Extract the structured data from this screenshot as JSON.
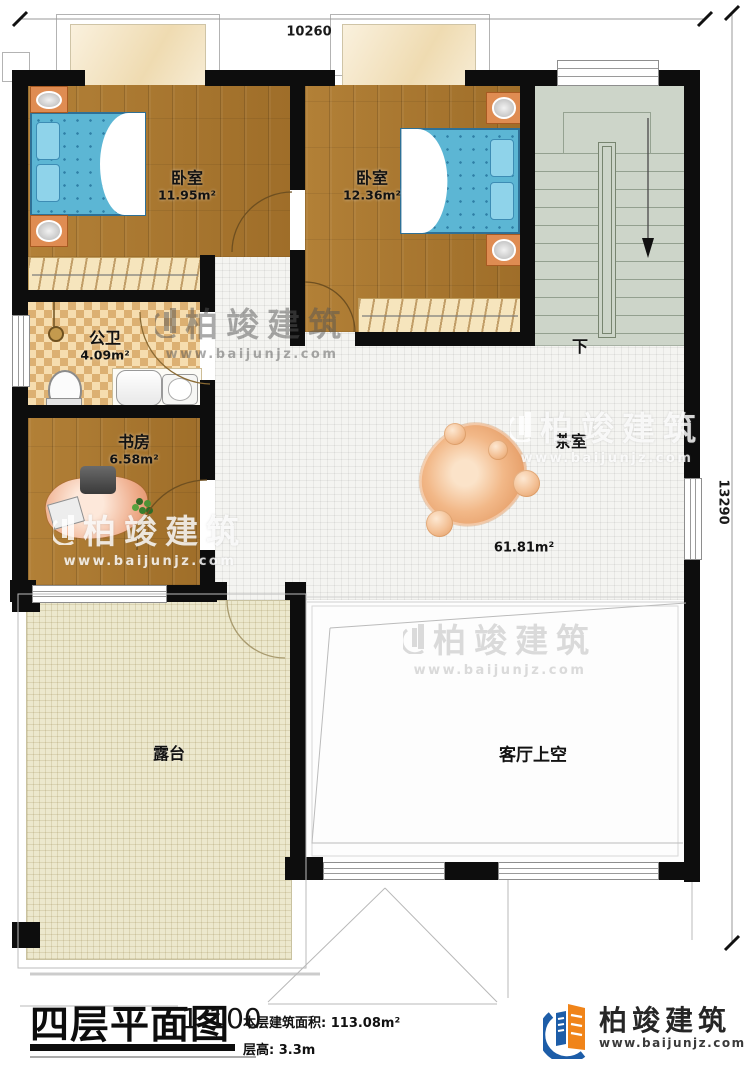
{
  "title_block": {
    "title": "四层平面图",
    "scale": "1:100",
    "area_label": "本层建筑面积:",
    "area_value": "113.08m²",
    "height_label": "层高:",
    "height_value": "3.3m"
  },
  "brand": {
    "name": "柏竣建筑",
    "url": "www.baijunjz.com"
  },
  "dimensions": {
    "top": "10260",
    "right": "13290"
  },
  "rooms": [
    {
      "id": "bedroom-1",
      "label": "卧室",
      "area": "11.95m²"
    },
    {
      "id": "bedroom-2",
      "label": "卧室",
      "area": "12.36m²"
    },
    {
      "id": "bathroom",
      "label": "公卫",
      "area": "4.09m²"
    },
    {
      "id": "study",
      "label": "书房",
      "area": "6.58m²"
    },
    {
      "id": "tea-room",
      "label": "茶室",
      "area": "61.81m²"
    },
    {
      "id": "terrace",
      "label": "露台"
    },
    {
      "id": "living-void",
      "label": "客厅上空"
    }
  ],
  "stairs": {
    "down_label": "下"
  },
  "colors": {
    "wall": "#0d0d0d",
    "wood": "#a8772f",
    "stair": "#cdd5c9",
    "accent_orange": "#f08419",
    "accent_blue": "#1d5da8"
  }
}
